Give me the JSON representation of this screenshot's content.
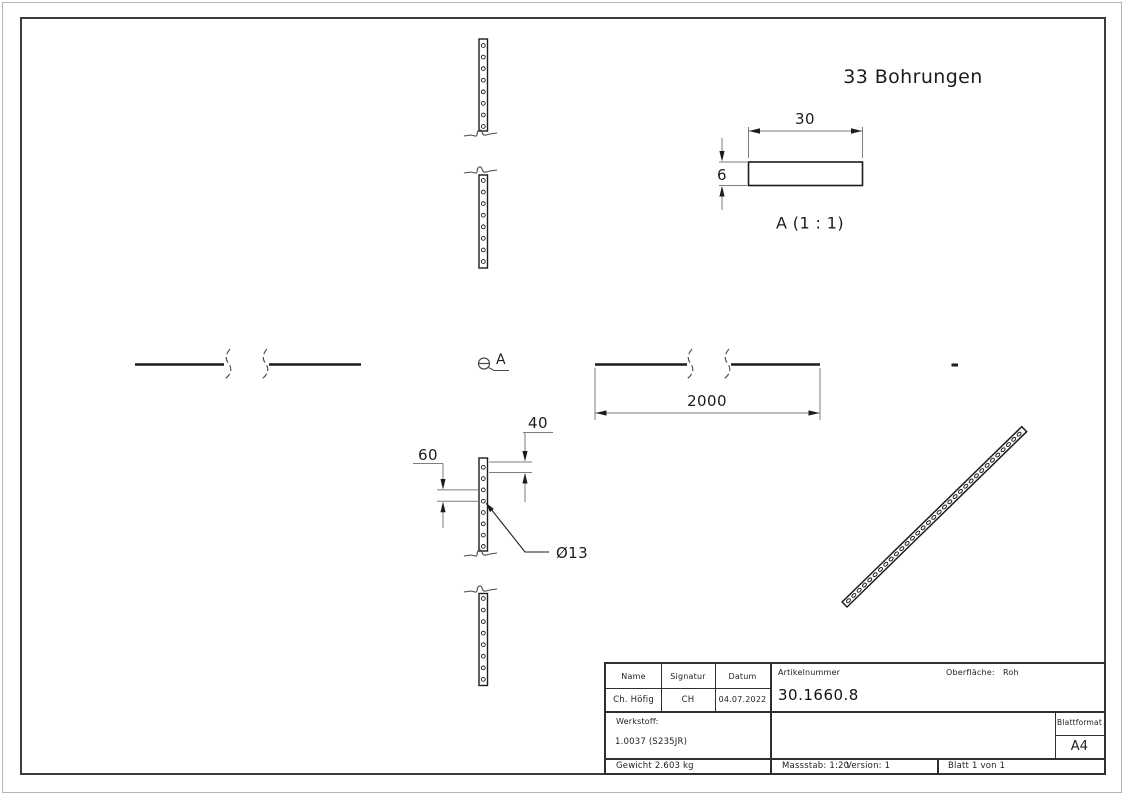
{
  "labels": {
    "holes_note": "33 Bohrungen",
    "detail_view_title": "A (1 : 1)",
    "detail_marker": "A",
    "length": "2000",
    "width": "30",
    "thickness": "6",
    "end_distance": "40",
    "pitch": "60",
    "hole_diameter": "Ø13"
  },
  "title_block": {
    "col_name": "Name",
    "col_signature": "Signatur",
    "col_date": "Datum",
    "name": "Ch. Höfig",
    "signature": "CH",
    "date": "04.07.2022",
    "article_label": "Artikelnummer",
    "article_number": "30.1660.8",
    "surface_label": "Oberfläche:",
    "surface_value": "Roh",
    "material_label": "Werkstoff:",
    "material_value": "1.0037 (S235JR)",
    "sheet_format_label": "Blattformat",
    "sheet_format": "A4",
    "weight": "Gewicht 2.603 kg",
    "scale": "Massstab: 1:20",
    "version": "Version: 1",
    "sheet": "Blatt 1 von 1"
  },
  "colors": {
    "edge": "#1c1c1c",
    "dimension": "#7e7e7e",
    "frame": "#3c3c3c",
    "background": "#ffffff"
  }
}
